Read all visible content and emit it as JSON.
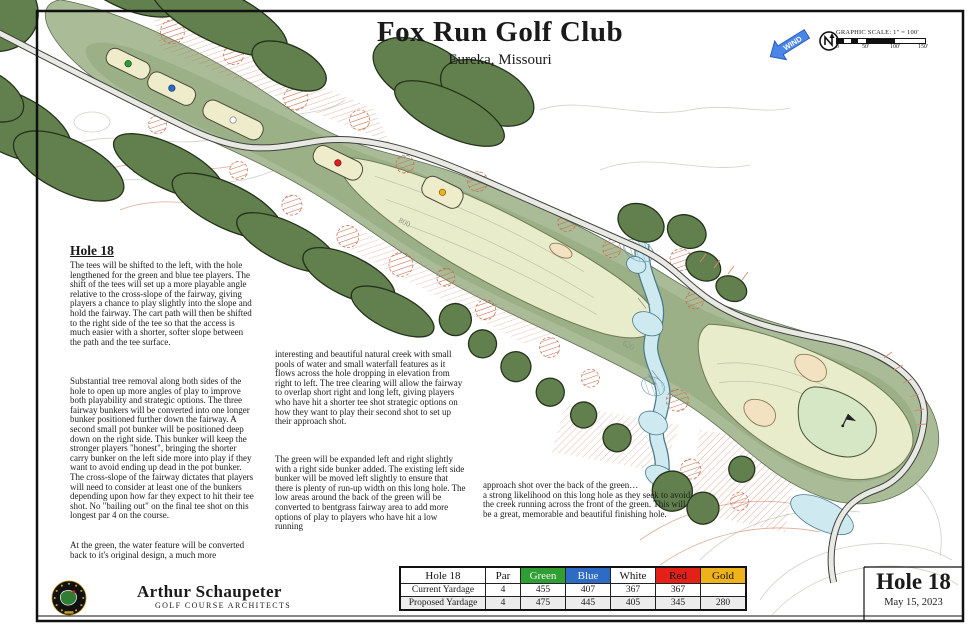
{
  "title": {
    "club": "Fox Run Golf Club",
    "location": "Eureka, Missouri"
  },
  "legend": {
    "wind_label": "WIND",
    "scale_title": "GRAPHIC SCALE:  1\" = 100'",
    "scale_ticks": [
      "0",
      "50'",
      "100'",
      "150'"
    ]
  },
  "notes": {
    "heading": "Hole 18",
    "col1_p1": "The tees will be shifted to the left, with the hole lengthened for the green and blue tee players.  The shift of the tees will set up a more playable angle relative to the cross-slope of the fairway, giving players a chance to play slightly into the slope and hold the fairway.  The cart path will then be shifted to the right side of the tee so that the access is much easier with a shorter, softer slope between the path and the tee surface.",
    "col1_p2": "Substantial tree removal along both sides of the hole to open up more angles of play to improve both playability and strategic options.  The three fairway bunkers will be converted into one longer bunker positioned further down the fairway.  A second small pot bunker will be positioned deep down on the right side.  This bunker will keep the stronger players \"honest\", bringing the shorter carry bunker on the left side more into play if they want to avoid ending up dead in the pot bunker.  The cross-slope of the fairway dictates that players will need to consider at least one of the bunkers depending upon how far they expect to hit their tee shot.  No \"bailing out\" on the final tee shot on this longest par 4 on the course.",
    "col1_p3": "At the green, the water feature will be converted back to it's original design, a much more",
    "col2_p1": "interesting and beautiful natural creek with small pools of water and small waterfall features as it flows across the hole dropping in elevation from right to left.  The tree clearing will allow the fairway to overlap short right and long left, giving players who have hit a shorter tee shot strategic options on how they want to play their second shot to set up their approach shot.",
    "col2_p2": "The green will be expanded left and right slightly with a right side bunker added.  The existing left side bunker will be moved left slightly to ensure that there is plenty of run-up width on this long hole.  The low areas around the back of the green will be converted to bentgrass fairway area to add more options of play to players who have hit a low running",
    "col3_p1": "approach shot over the back of the green…\na strong likelihood on this long hole as they seek to avoid the creek running across the front of the green.  This will be a great, memorable and beautiful finishing hole."
  },
  "map": {
    "contour_labels": [
      "800",
      "620"
    ],
    "tee_colors": {
      "green": "#2f9e33",
      "blue": "#2e6bc4",
      "white": "#ffffff",
      "red": "#e02020",
      "gold": "#eeb31b"
    },
    "palette": {
      "rough": "#a9bb97",
      "fairway": "#e9eccb",
      "putting_green": "#d6e7c6",
      "trees": "#62804e",
      "bunker": "#f3e2c2",
      "water": "#cfe9f1",
      "removal_hatch": "#c96a4a"
    }
  },
  "yardage_table": {
    "header": [
      "Hole 18",
      "Par",
      "Green",
      "Blue",
      "White",
      "Red",
      "Gold"
    ],
    "header_colors": {
      "green": "#2f9e33",
      "blue": "#2e6bc4",
      "white": "#ffffff",
      "red": "#e32119",
      "gold": "#eeb31b"
    },
    "rows": [
      [
        "Current Yardage",
        "4",
        "455",
        "407",
        "367",
        "367",
        ""
      ],
      [
        "Proposed Yardage",
        "4",
        "475",
        "445",
        "405",
        "345",
        "280"
      ]
    ]
  },
  "footer": {
    "architect": "Arthur Schaupeter",
    "architect_sub": "GOLF COURSE ARCHITECTS",
    "hole_title": "Hole 18",
    "date": "May 15, 2023"
  }
}
